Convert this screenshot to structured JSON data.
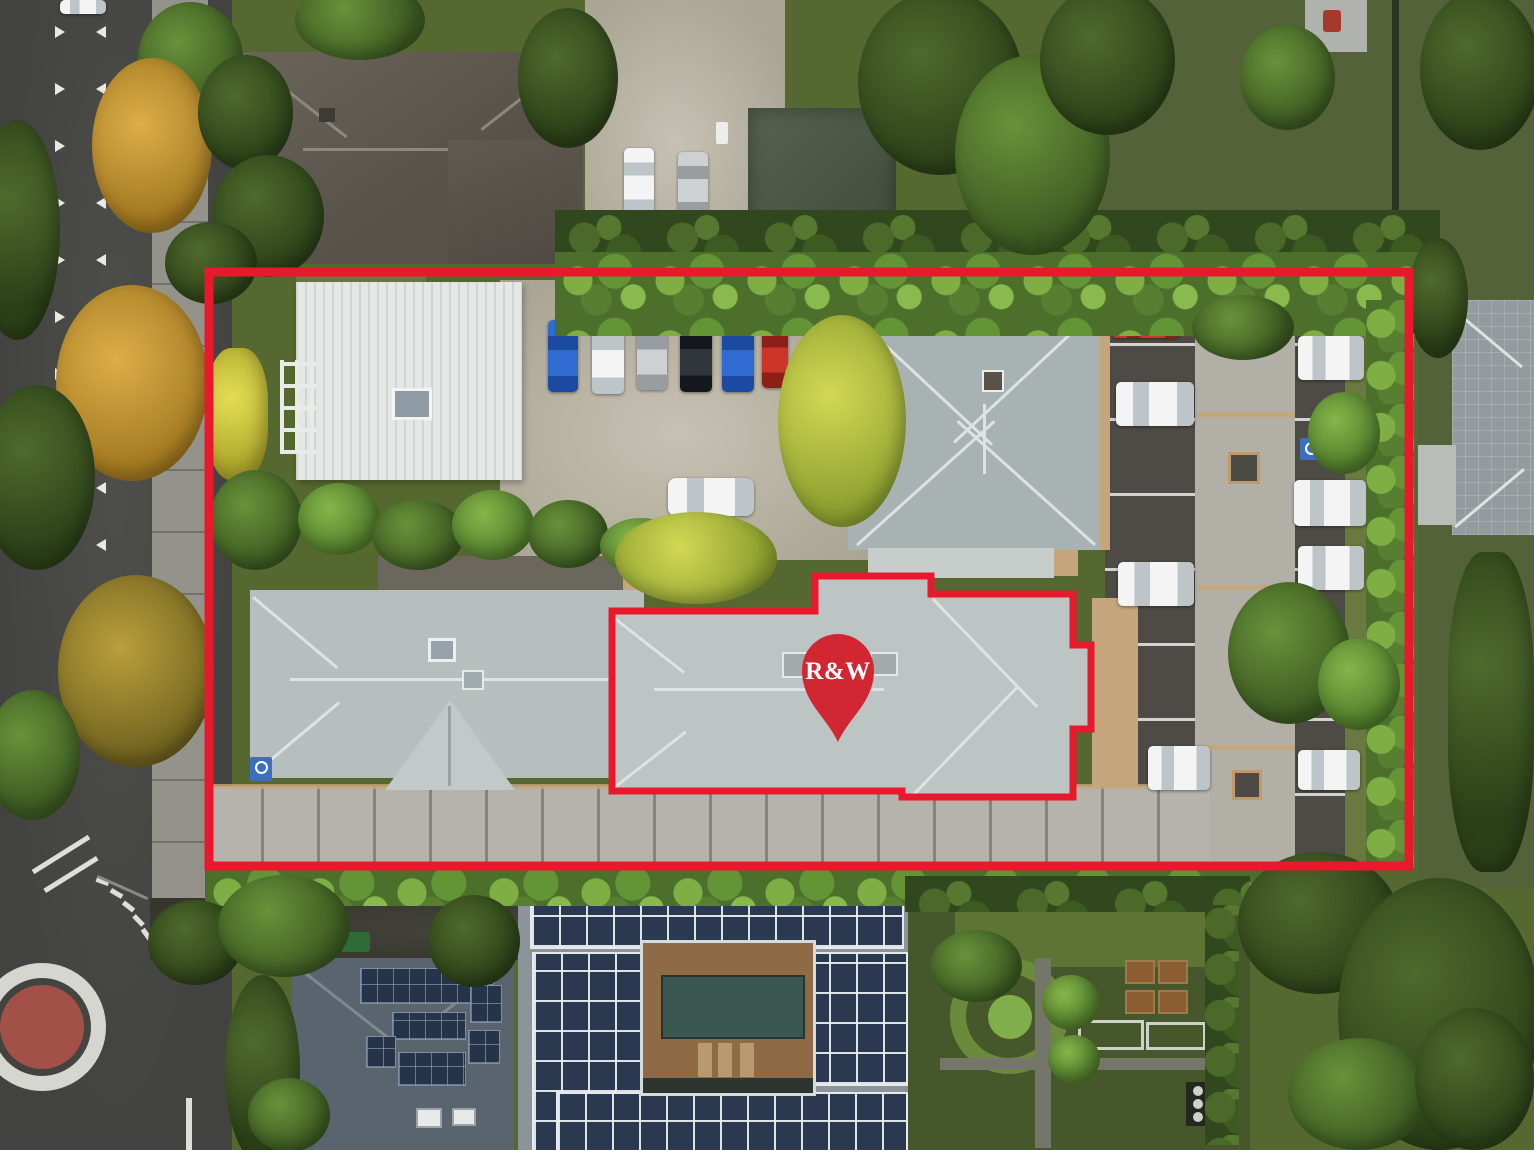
{
  "annotations": {
    "pin": {
      "label": "R&W",
      "color": "#d22733",
      "label_color": "#ffffff"
    },
    "property_boundary": {
      "color": "#e8192c",
      "style": "solid rectangular outline"
    },
    "building_outline": {
      "color": "#e8192c",
      "style": "solid building-footprint outline"
    }
  },
  "scene": {
    "description": "Aerial drone photo of a property: light-gray hip-roof buildings, gravel and sealed parking with cars, hedges and autumn trees, road with roundabout at lower left, solar-panelled buildings with a courtyard pool below, formal garden at lower right.",
    "gravel_row_car_colors": [
      "blue",
      "white",
      "silver",
      "black",
      "blue",
      "red"
    ],
    "right_lot_car_colors": [
      "red",
      "white",
      "white",
      "white",
      "white",
      "white",
      "white"
    ],
    "top_lot_car_colors": [
      "white",
      "silver"
    ],
    "van_color": "white",
    "roundabout_centre_color": "#a35148"
  }
}
